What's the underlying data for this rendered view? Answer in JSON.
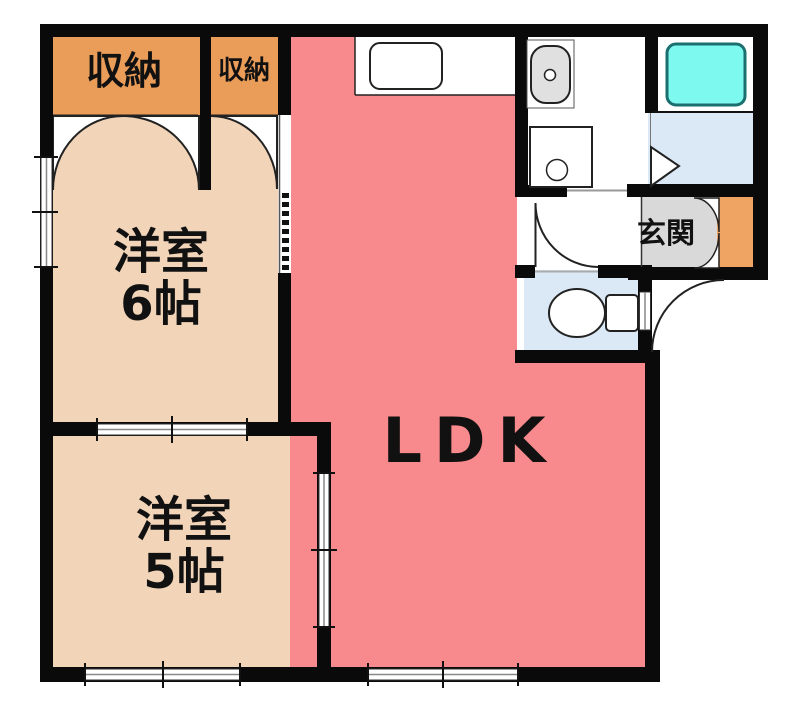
{
  "plan": {
    "type": "apartment-floor-plan",
    "rooms": {
      "ldk": {
        "label": "LDK"
      },
      "western_room_6": {
        "name_line": "洋室",
        "size_line": "6帖"
      },
      "western_room_5": {
        "name_line": "洋室",
        "size_line": "5帖"
      },
      "closet_large": {
        "label": "収納"
      },
      "closet_small": {
        "label": "収納"
      },
      "entrance": {
        "label": "玄関"
      }
    },
    "fixtures": [
      "kitchen-counter",
      "kitchen-sink",
      "vanity-sink",
      "washing-machine-pan",
      "bathtub",
      "bathroom-folding-door",
      "toilet",
      "toilet-door-swing",
      "entrance-door-swing",
      "shoe-cabinet",
      "closet-double-doors",
      "closet-single-door",
      "window",
      "sliding-door"
    ],
    "colors": {
      "wall": "#0a0a0a",
      "ldk_floor": "#F8898C",
      "western_room_floor": "#F2D4B8",
      "closet_fill": "#EA9C59",
      "shoe_cabinet_fill": "#EFA464",
      "entrance_floor": "#D9D9D9",
      "wet_area_floor": "#DBE8F6",
      "bathtub_fill": "#7EF9EF",
      "bathtub_border": "#1b6f6f",
      "fixture_gray": "#E0E0E0",
      "background": "#ffffff"
    }
  }
}
